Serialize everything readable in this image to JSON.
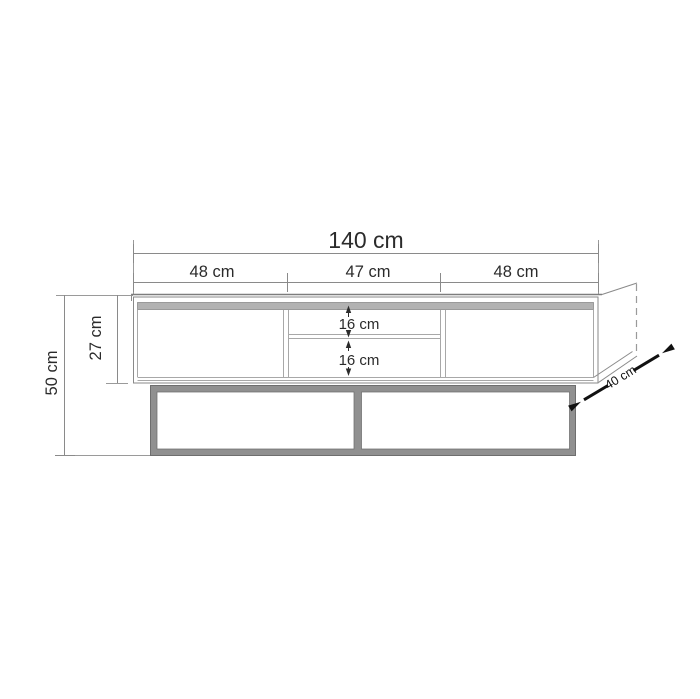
{
  "diagram": {
    "type": "furniture-dimension-drawing",
    "subject": "TV stand with metal base frame",
    "unit": "cm",
    "dimensions": {
      "total_width": "140 cm",
      "section_left": "48 cm",
      "section_middle": "47 cm",
      "section_right": "48 cm",
      "body_height": "27 cm",
      "total_height": "50 cm",
      "shelf_upper": "16 cm",
      "shelf_lower": "16 cm",
      "depth": "40 cm"
    },
    "colors": {
      "background": "#ffffff",
      "drawing_line": "#8a8a8a",
      "extension_line": "#9a9a9a",
      "text": "#2b2b2b",
      "top_band": "#b2b2b2",
      "base_frame": "#909090",
      "depth_arrow": "#111111"
    }
  }
}
